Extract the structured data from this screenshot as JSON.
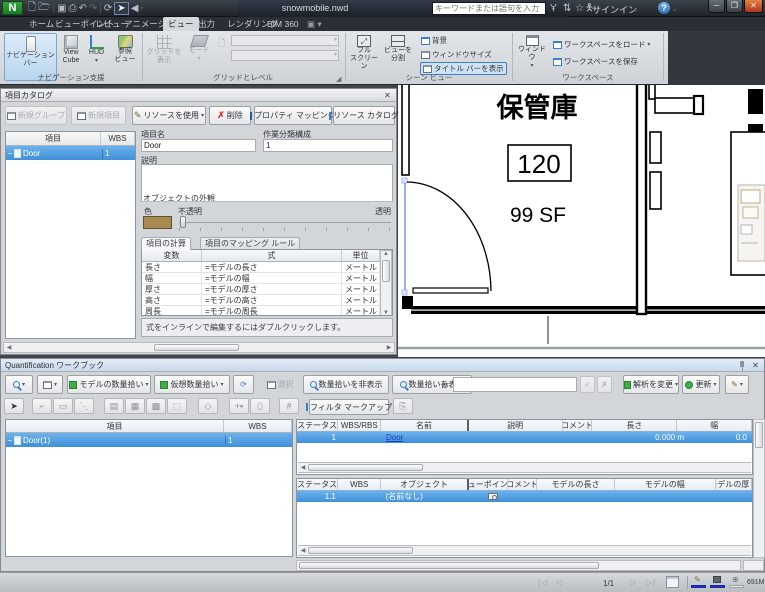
{
  "titlebar": {
    "app": "N",
    "title": "snowmobile.nwd",
    "search_placeholder": "キーワードまたは語句を入力",
    "signin": "サインイン"
  },
  "tabs": {
    "items": [
      "ホーム",
      "ビューポイント",
      "レビュー",
      "アニメーション",
      "ビュー",
      "出力",
      "レンダリング",
      "BIM 360"
    ],
    "active": "ビュー"
  },
  "ribbon": {
    "nav_aids": {
      "label": "ナビゲーション支援",
      "nav_bar": "ナビゲーション\nバー",
      "view_cube": "View\nCube",
      "hud": "HUD",
      "ref_views": "参照\nビュー"
    },
    "grids": {
      "label": "グリッドとレベル",
      "show_grid": "グリッドを\n表示",
      "mode": "モード"
    },
    "scene_view": {
      "label": "シーン ビュー",
      "full_screen": "フル\nスクリーン",
      "split_view": "ビューを\n分割",
      "background": "背景",
      "window_size": "ウィンドウサイズ",
      "show_title_bars": "タイトル バーを表示"
    },
    "workspace": {
      "label": "ワークスペース",
      "windows": "ウィンドウ",
      "load_workspace": "ワークスペースをロード",
      "save_workspace": "ワークスペースを保存"
    }
  },
  "catalog": {
    "title": "項目カタログ",
    "toolbar": {
      "new_group": "新規グループ",
      "new_item": "新規項目",
      "use_resource": "リソースを使用",
      "delete": "削除",
      "property_mapping": "プロパティ マッピング",
      "resource_catalog": "リソース カタログ"
    },
    "tree": {
      "col_item": "項目",
      "col_wbs": "WBS",
      "row_item": "Door",
      "row_wbs": "1"
    },
    "detail": {
      "name_label": "項目名",
      "name_value": "Door",
      "wbs_label": "作業分類構成",
      "wbs_value": "1",
      "desc_label": "説明",
      "appearance_label": "オブジェクトの外観",
      "color_label": "色",
      "opaque_label": "不透明",
      "transparent_label": "透明",
      "color_hex": "#a68a50",
      "tab_calc": "項目の計算",
      "tab_mapping": "項目のマッピング ルール",
      "calc": {
        "col_var": "変数",
        "col_formula": "式",
        "col_unit": "単位",
        "rows": [
          [
            "長さ",
            "=モデルの長さ",
            "メートル"
          ],
          [
            "幅",
            "=モデルの幅",
            "メートル"
          ],
          [
            "厚さ",
            "=モデルの厚さ",
            "メートル"
          ],
          [
            "高さ",
            "=モデルの高さ",
            "メートル"
          ],
          [
            "周長",
            "=モデルの周長",
            "メートル"
          ]
        ]
      },
      "hint": "式をインラインで編集するにはダブルクリックします。"
    }
  },
  "plan": {
    "room_name": "保管庫",
    "room_number": "120",
    "room_area": "99 SF"
  },
  "workbook": {
    "title": "Quantification ワークブック",
    "toolbar": {
      "model_takeoff": "モデルの数量拾い",
      "virtual_takeoff": "仮想数量拾い",
      "select": "選択",
      "hide_takeoff": "数量拾いを非表示",
      "show_takeoff": "数量拾いを表示",
      "fx": "ƒx",
      "change_analysis": "解析を変更",
      "update": "更新",
      "filter_markup": "フィルタ マークアップ"
    },
    "items": {
      "col_item": "項目",
      "col_wbs": "WBS",
      "row_item": "Door(1)",
      "row_wbs": "1"
    },
    "takeoff": {
      "cols": [
        "ステータス",
        "WBS/RBS",
        "名前",
        "説明",
        "コメント",
        "長さ",
        "幅"
      ],
      "row": {
        "wbs": "1",
        "name": "Door",
        "length": "0.000 m",
        "width": "0.0"
      }
    },
    "objects": {
      "cols": [
        "ステータス",
        "WBS",
        "オブジェクト",
        "ビューポイント",
        "コメント",
        "モデルの長さ",
        "モデルの幅",
        "モデルの厚さ"
      ],
      "row": {
        "wbs": "1.1",
        "object": "(名前なし)"
      }
    }
  },
  "statusbar": {
    "page": "1/1",
    "memory": "691MB"
  }
}
